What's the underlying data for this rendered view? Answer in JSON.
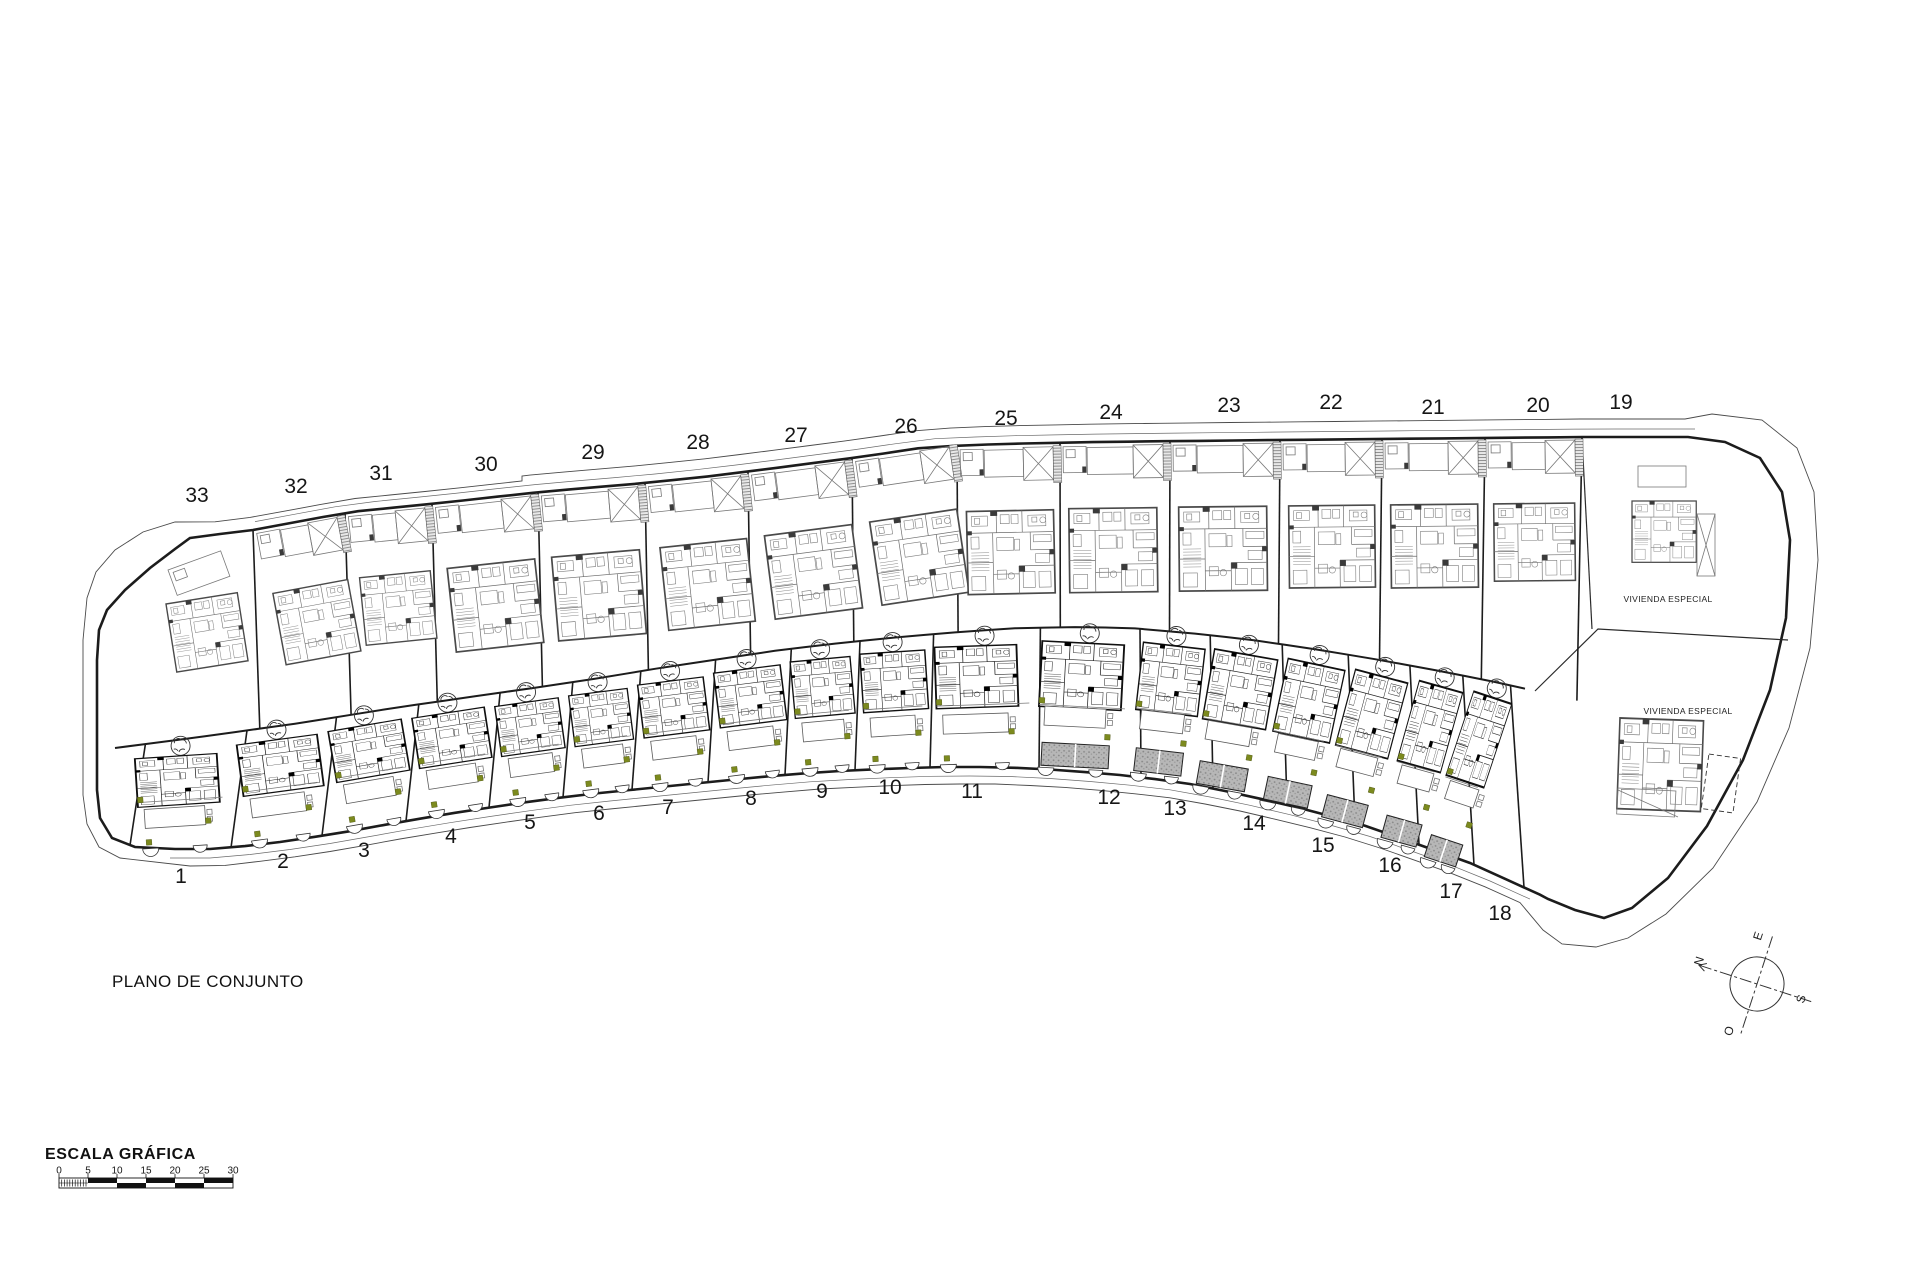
{
  "title": "PLANO DE CONJUNTO",
  "scale": {
    "label": "ESCALA GRÁFICA",
    "ticks": [
      "0",
      "5",
      "10",
      "15",
      "20",
      "25",
      "30"
    ]
  },
  "compass": {
    "n": "N",
    "e": "E",
    "s": "S",
    "o": "O"
  },
  "special_labels": [
    {
      "text": "VIVIENDA ESPECIAL"
    },
    {
      "text": "VIVIENDA ESPECIAL"
    }
  ],
  "plots": {
    "top": [
      {
        "number": "33"
      },
      {
        "number": "32"
      },
      {
        "number": "31"
      },
      {
        "number": "30"
      },
      {
        "number": "29"
      },
      {
        "number": "28"
      },
      {
        "number": "27"
      },
      {
        "number": "26"
      },
      {
        "number": "25"
      },
      {
        "number": "24"
      },
      {
        "number": "23"
      },
      {
        "number": "22"
      },
      {
        "number": "21"
      },
      {
        "number": "20"
      },
      {
        "number": "19"
      }
    ],
    "bottom": [
      {
        "number": "1"
      },
      {
        "number": "2"
      },
      {
        "number": "3"
      },
      {
        "number": "4"
      },
      {
        "number": "5"
      },
      {
        "number": "6"
      },
      {
        "number": "7"
      },
      {
        "number": "8"
      },
      {
        "number": "9"
      },
      {
        "number": "10"
      },
      {
        "number": "11"
      },
      {
        "number": "12"
      },
      {
        "number": "13"
      },
      {
        "number": "14"
      },
      {
        "number": "15"
      },
      {
        "number": "16"
      },
      {
        "number": "17"
      },
      {
        "number": "18"
      }
    ]
  },
  "colors": {
    "line": "#1c1c1c",
    "light_line": "#787878",
    "plant_green": "#7c8a1e",
    "drive_gray": "#b7b7b7"
  }
}
